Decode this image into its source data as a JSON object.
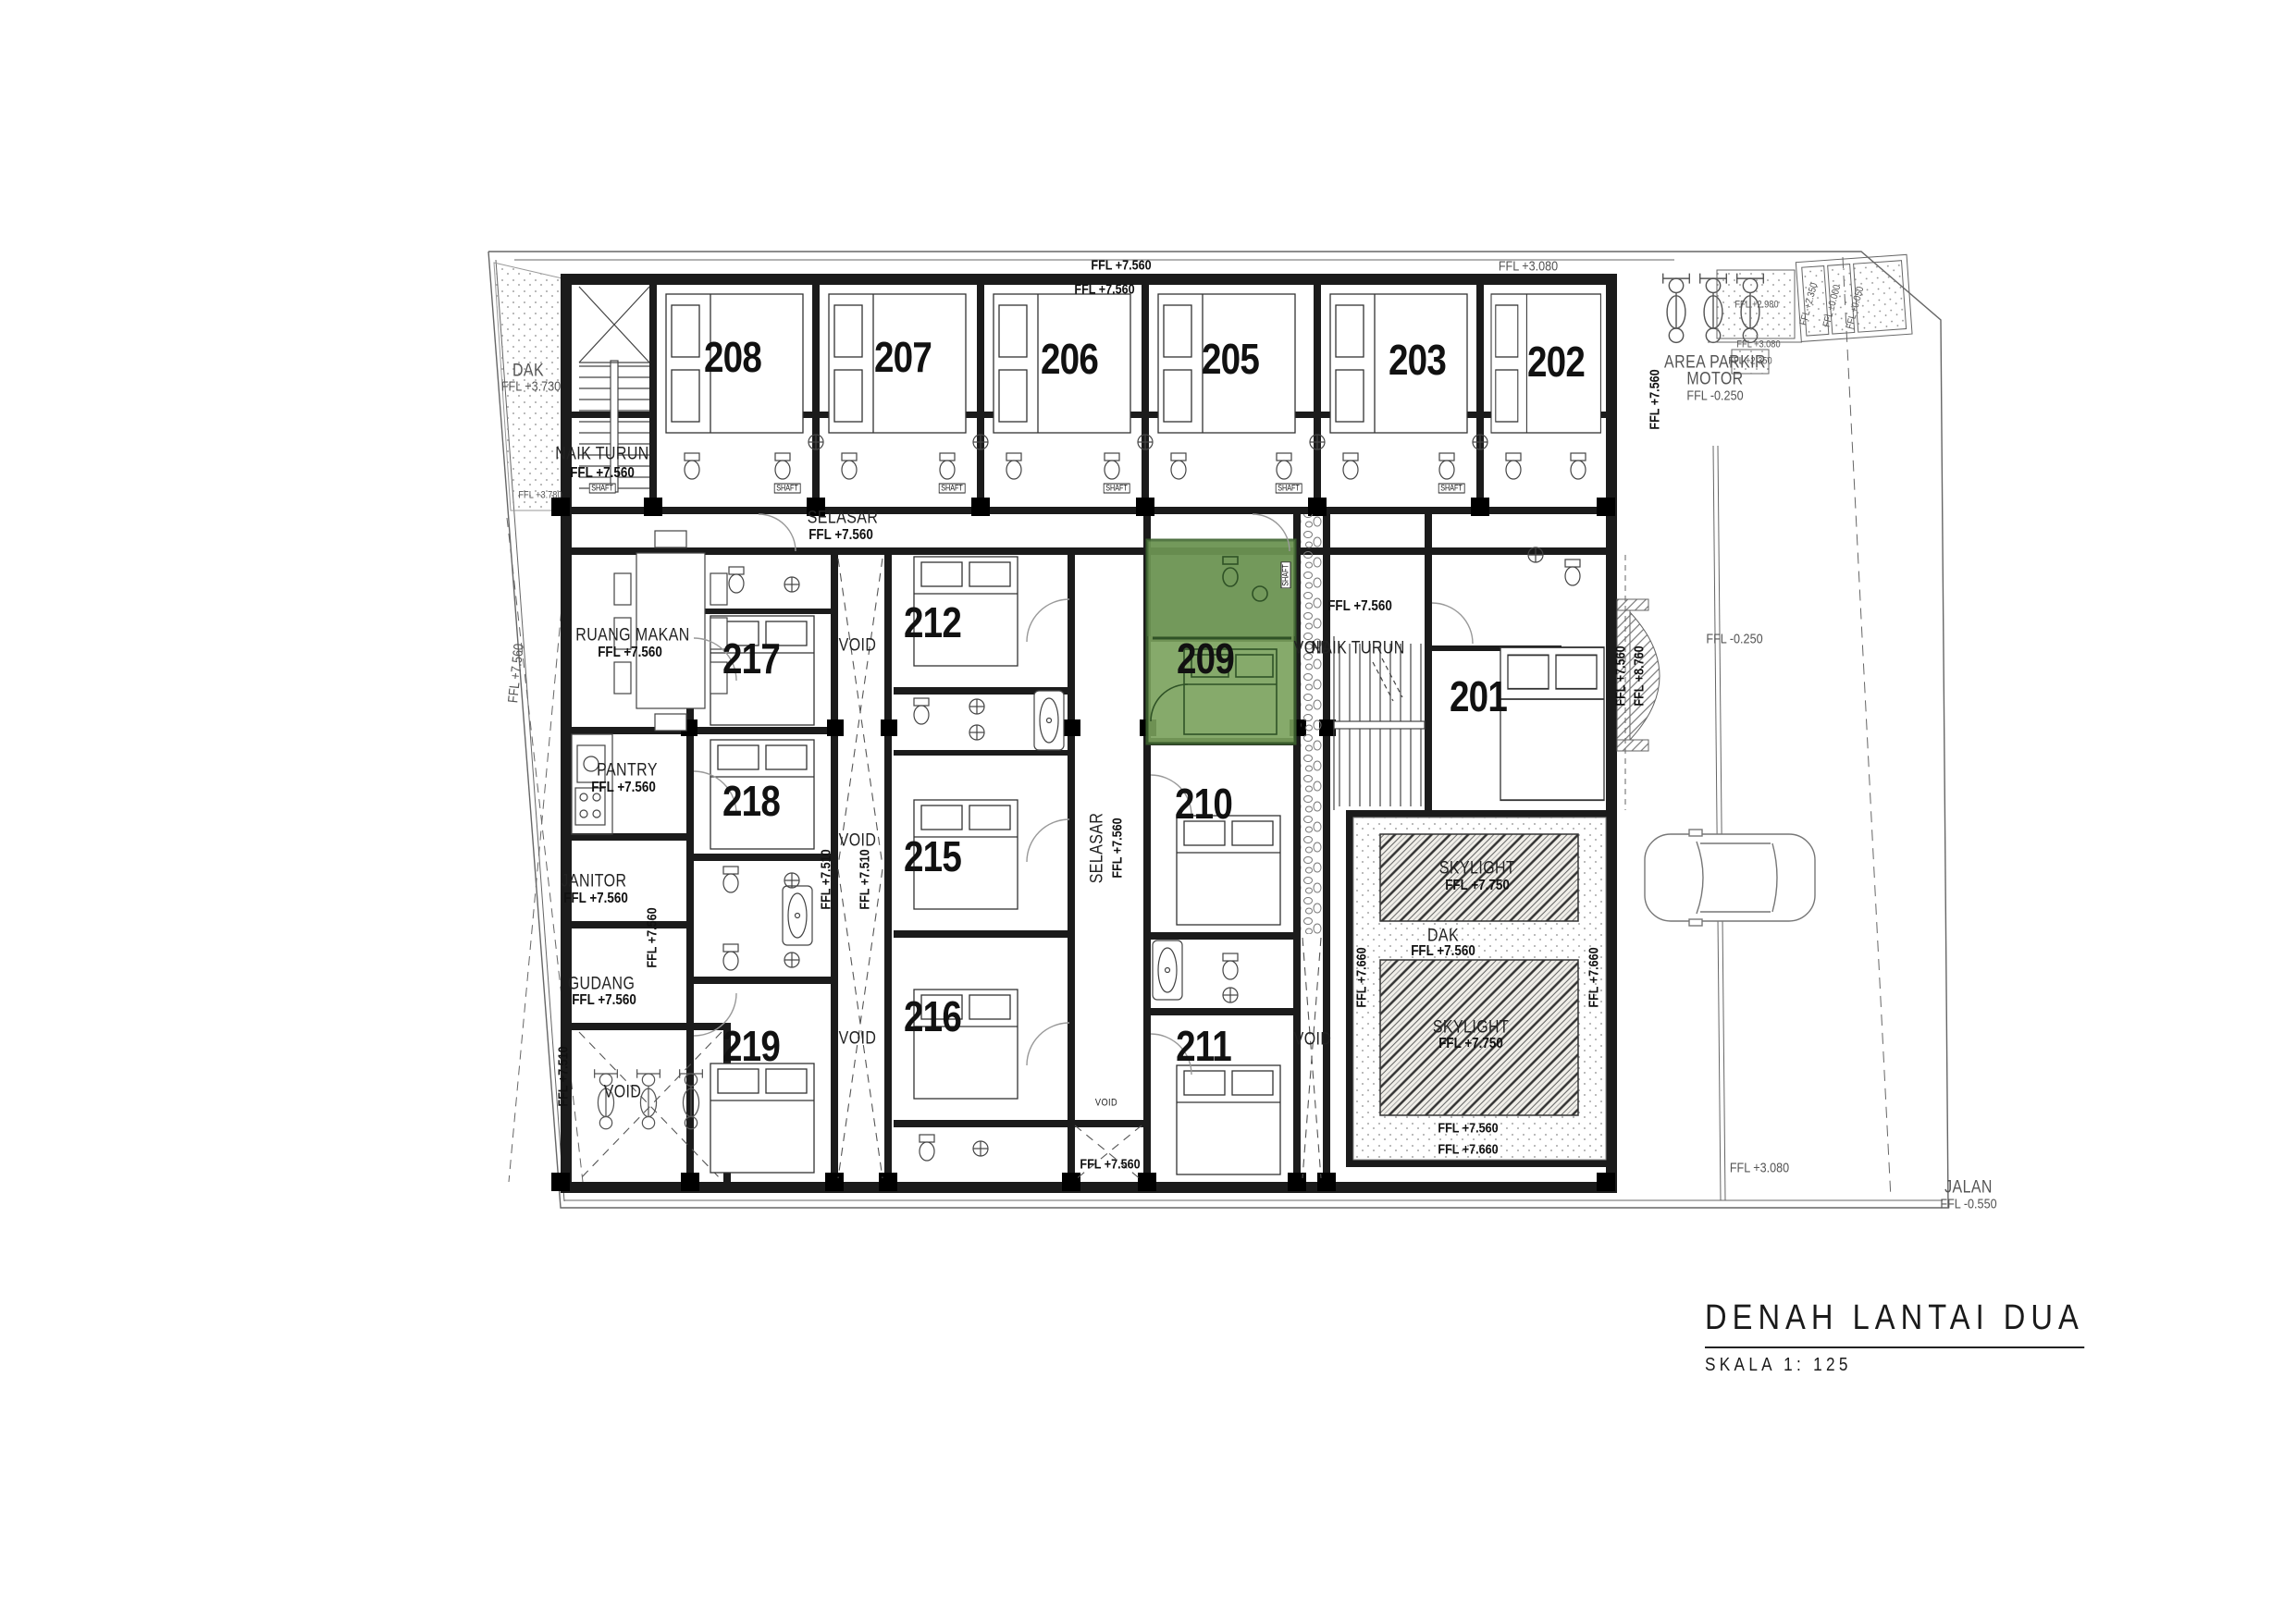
{
  "title": {
    "main": "DENAH LANTAI DUA",
    "scale": "SKALA 1: 125"
  },
  "rooms": {
    "r208": "208",
    "r207": "207",
    "r206": "206",
    "r205": "205",
    "r203": "203",
    "r202": "202",
    "r217": "217",
    "r218": "218",
    "r219": "219",
    "r212": "212",
    "r215": "215",
    "r216": "216",
    "r209": "209",
    "r210": "210",
    "r211": "211",
    "r201": "201"
  },
  "areas": {
    "selasar": "SELASAR",
    "ruang_makan": "RUANG MAKAN",
    "pantry": "PANTRY",
    "janitor": "JANITOR",
    "gudang": "GUDANG",
    "naik_turun": "NAIK TURUN",
    "area_parkir_1": "AREA PARKIR",
    "area_parkir_2": "MOTOR",
    "dak": "DAK",
    "skylight": "SKYLIGHT",
    "jalan": "JALAN",
    "void": "VOID",
    "shaft": "SHAFT"
  },
  "levels": {
    "l7560": "FFL +7.560",
    "l7510": "FFL +7.510",
    "l7660": "FFL +7.660",
    "l7750": "FFL +7.750",
    "l8760": "FFL +8.760",
    "l3730": "FFL +3.730",
    "l3780": "FFL +3.780",
    "l3080": "FFL +3.080",
    "l2980": "FFL +2.980",
    "l2350": "FFL +2.350",
    "l0000": "FFL ±0.000",
    "l0050": "FFL +0.050",
    "lm0250": "FFL -0.250",
    "lm0550": "FFL -0.550"
  },
  "colors": {
    "highlight": "#7AA15C",
    "highlight_dark": "#2F5226"
  }
}
